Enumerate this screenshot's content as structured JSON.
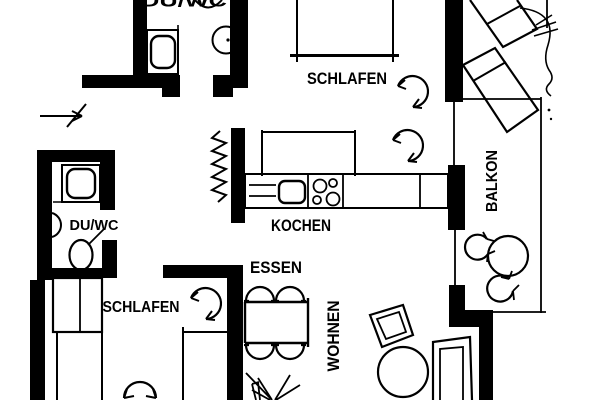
{
  "document": {
    "type": "architectural floor plan",
    "style": "black-and-white scanned blueprint of an apartment with balcony"
  },
  "rooms": [
    {
      "id": "bath-top",
      "label": "DU/WC"
    },
    {
      "id": "bedroom-top",
      "label": "SCHLAFEN"
    },
    {
      "id": "kitchen",
      "label": "KOCHEN"
    },
    {
      "id": "dining",
      "label": "ESSEN"
    },
    {
      "id": "living",
      "label": "WOHNEN"
    },
    {
      "id": "balcony",
      "label": "BALKON"
    },
    {
      "id": "bedroom-bottom",
      "label": "SCHLAFEN"
    },
    {
      "id": "bath-middle",
      "label": "DU/WC"
    }
  ],
  "symbols": {
    "entrance": "entry arrow pointing right",
    "door_swing": "arc with double arrowheads",
    "plant": "freehand foliage lines",
    "lounge_chairs": 2,
    "balcony_chairs": 2,
    "dining_chairs": 4
  },
  "colors": {
    "ink": "#000000",
    "paper": "#ffffff"
  }
}
